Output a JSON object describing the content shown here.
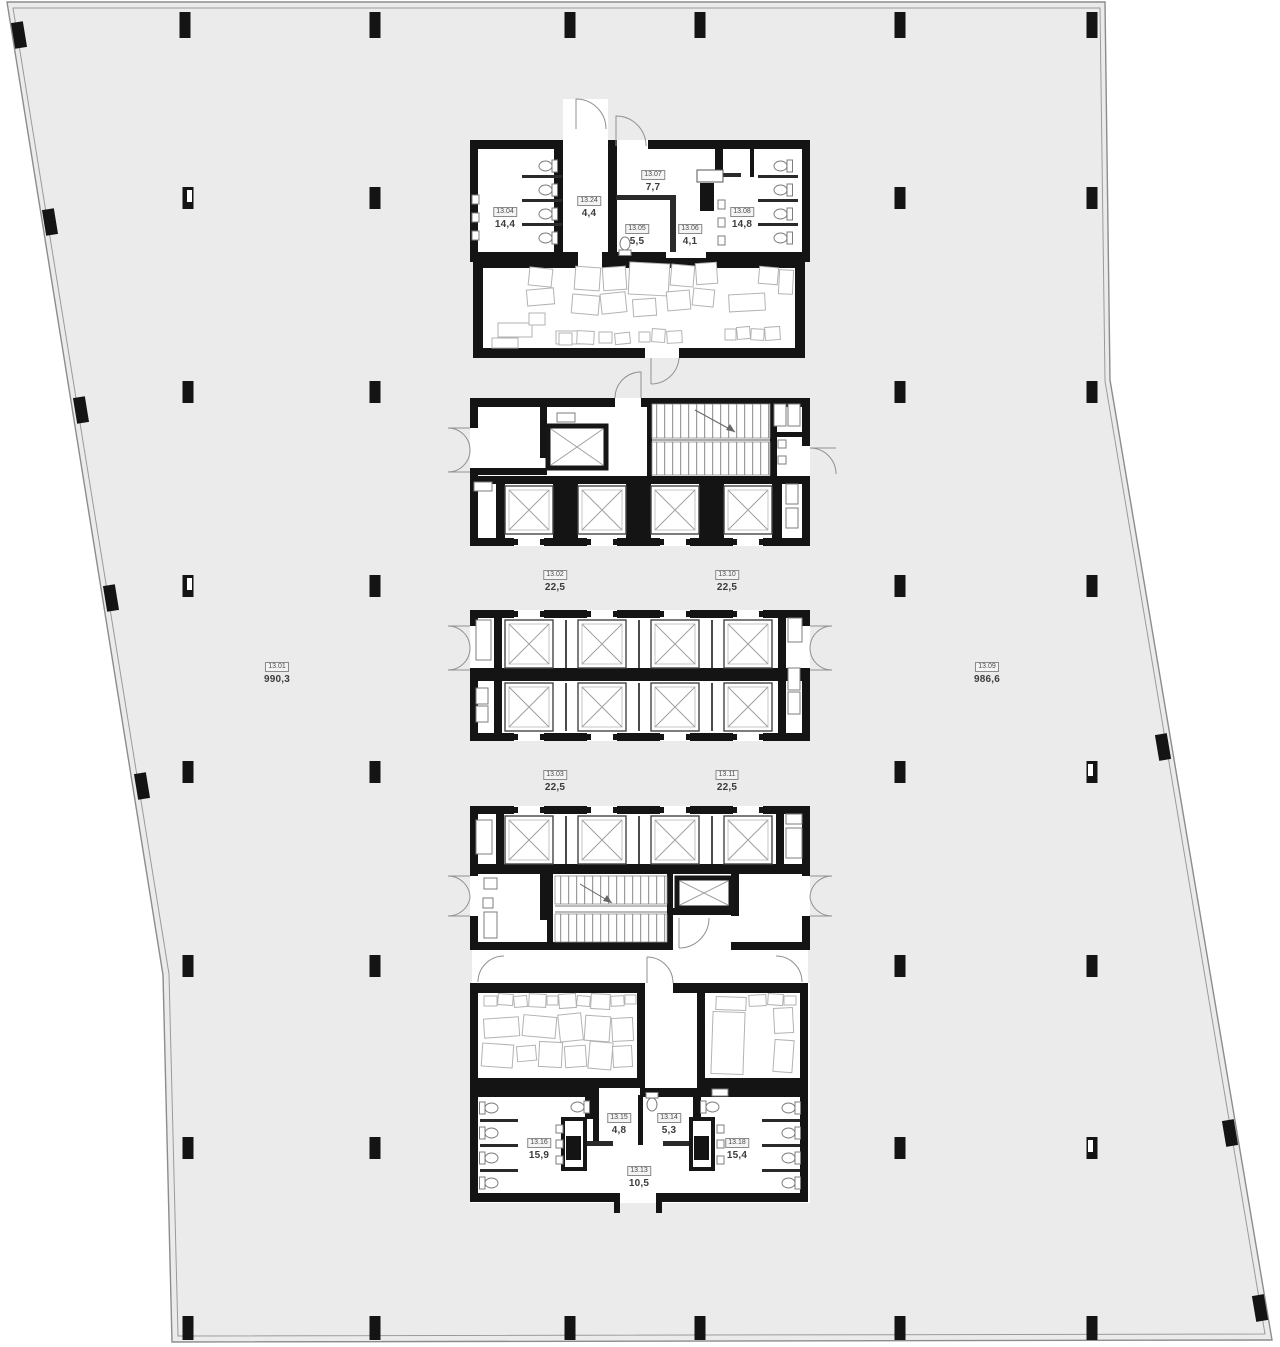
{
  "meta": {
    "drawing_type": "architectural floor plan",
    "level_prefix": "13"
  },
  "colors": {
    "background": "#ffffff",
    "floor_fill": "#ebebeb",
    "outline_line": "#8c8c8c",
    "wall": "#141414",
    "partition": "#2a2a2a",
    "fixture_line": "#7d7d7d",
    "furniture_line": "#b3b3b3",
    "shaft_cross": "#a0a0a0",
    "label_text": "#3c3c3c",
    "label_box_fill": "#f4f4f4",
    "label_box_border": "#8a8a8a"
  },
  "rooms": [
    {
      "id": "13.01",
      "area": "990,3"
    },
    {
      "id": "13.09",
      "area": "986,6"
    },
    {
      "id": "13.04",
      "area": "14,4"
    },
    {
      "id": "13.24",
      "area": "4,4"
    },
    {
      "id": "13.07",
      "area": "7,7"
    },
    {
      "id": "13.05",
      "area": "5,5"
    },
    {
      "id": "13.06",
      "area": "4,1"
    },
    {
      "id": "13.08",
      "area": "14,8"
    },
    {
      "id": "13.02",
      "area": "22,5"
    },
    {
      "id": "13.10",
      "area": "22,5"
    },
    {
      "id": "13.03",
      "area": "22,5"
    },
    {
      "id": "13.11",
      "area": "22,5"
    },
    {
      "id": "13.15",
      "area": "4,8"
    },
    {
      "id": "13.14",
      "area": "5,3"
    },
    {
      "id": "13.16",
      "area": "15,9"
    },
    {
      "id": "13.18",
      "area": "15,4"
    },
    {
      "id": "13.13",
      "area": "10,5"
    }
  ]
}
